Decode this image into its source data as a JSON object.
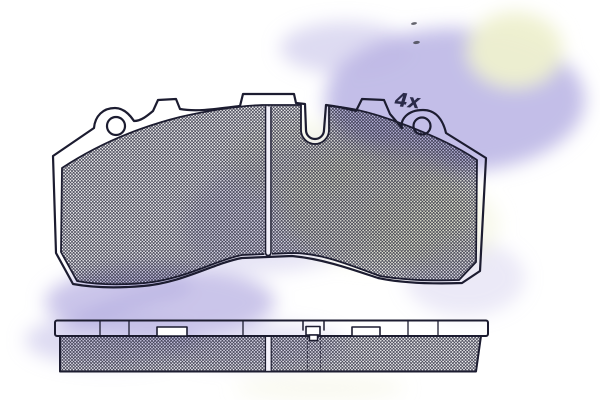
{
  "drawing": {
    "title": "brake-pad-technical-drawing",
    "annotation": {
      "quantity_label": "4x"
    },
    "views": {
      "front_view": "pad-front-view",
      "side_view": "pad-side-view"
    },
    "features": {
      "holes": 2,
      "hole_marker": "4x",
      "grooves": "center-groove",
      "wear_sensor_notch": "top-center-slot"
    },
    "colors": {
      "line": "#1c1c30",
      "watermark_lavender": "#bdb7e5",
      "watermark_yellow": "#eef0cf",
      "paper": "#ffffff"
    }
  }
}
